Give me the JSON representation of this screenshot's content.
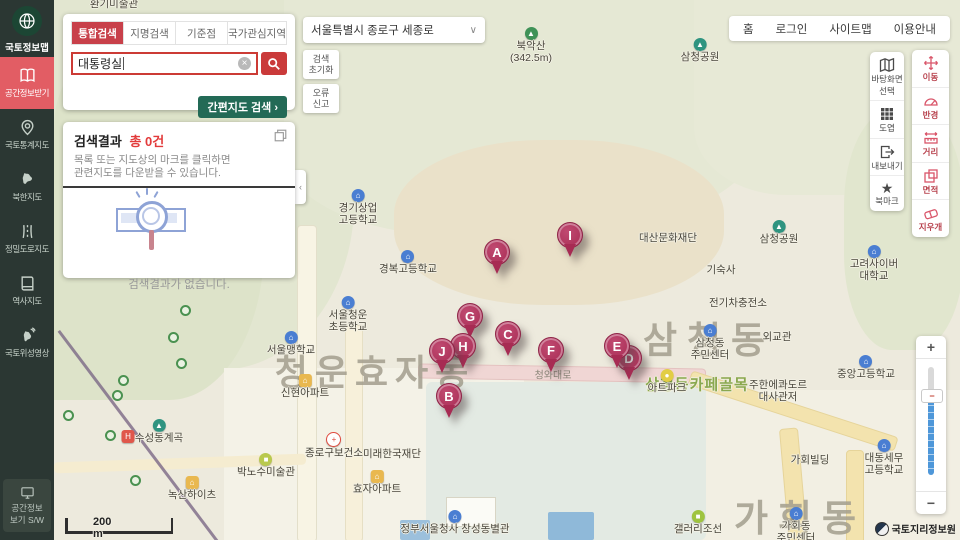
{
  "colors": {
    "sidebar_bg": "#2b3733",
    "sidebar_active": "#e25d64",
    "tab_active": "#c8404a",
    "search_border": "#cc3b35",
    "quick_button_green": "#236a56",
    "marker_pink": "#a72b53",
    "zoom_track_blue": "#4e97d9"
  },
  "icons": {
    "chevron_down": "∨",
    "arrow_right": "›",
    "collapse_left": "‹",
    "clear": "×",
    "star": "★"
  },
  "sidebar": {
    "logo_title": "국토정보맵",
    "items": [
      {
        "icon": "download-map-icon",
        "label": "공간정보받기",
        "active": true
      },
      {
        "icon": "stats-map-icon",
        "label": "국토통계지도",
        "active": false
      },
      {
        "icon": "nk-map-icon",
        "label": "북한지도",
        "active": false
      },
      {
        "icon": "road-map-icon",
        "label": "정밀도로지도",
        "active": false
      },
      {
        "icon": "history-map-icon",
        "label": "역사지도",
        "active": false
      },
      {
        "icon": "satellite-icon",
        "label": "국토위성영상",
        "active": false
      }
    ],
    "bottom": {
      "label_line1": "공간정보",
      "label_line2": "보기 S/W"
    }
  },
  "search_panel": {
    "tabs": [
      {
        "label": "통합검색",
        "active": true
      },
      {
        "label": "지명검색",
        "active": false
      },
      {
        "label": "기준점",
        "active": false
      },
      {
        "label": "국가관심지역",
        "active": false
      }
    ],
    "input_value": "대통령실",
    "quick_map_button": "간편지도 검색"
  },
  "results_panel": {
    "title": "검색결과",
    "count_text": "총 0건",
    "description_line1": "목록 또는 지도상의 마크를 클릭하면",
    "description_line2": "관련지도를 다운받을 수 있습니다.",
    "empty_text": "검색결과가 없습니다."
  },
  "top_bar": {
    "address": "서울특별시 종로구 세종로",
    "reset_button": [
      "검색",
      "초기화"
    ],
    "report_button": [
      "오류",
      "신고"
    ],
    "links": [
      "홈",
      "로그인",
      "사이트맵",
      "이용안내"
    ]
  },
  "map_tools_primary": [
    {
      "icon": "basemap-icon",
      "lines": [
        "바탕화면",
        "선택"
      ]
    },
    {
      "icon": "sheet-grid-icon",
      "lines": [
        "도엽"
      ]
    },
    {
      "icon": "export-icon",
      "lines": [
        "내보내기"
      ]
    },
    {
      "icon": "bookmark-icon",
      "lines": [
        "북마크"
      ]
    }
  ],
  "map_tools_measure": [
    {
      "icon": "move-icon",
      "lines": [
        "이동"
      ]
    },
    {
      "icon": "radius-icon",
      "lines": [
        "반경"
      ]
    },
    {
      "icon": "distance-icon",
      "lines": [
        "거리"
      ]
    },
    {
      "icon": "area-icon",
      "lines": [
        "면적"
      ]
    },
    {
      "icon": "eraser-icon",
      "lines": [
        "지우개"
      ]
    }
  ],
  "zoom_control": {
    "plus": "+",
    "minus": "−"
  },
  "scale_bar": "200 m",
  "attribution": "국토지리정보원",
  "map": {
    "districts": [
      {
        "text": "청운효자동",
        "x": 375,
        "y": 370,
        "size": 36,
        "spacing": 7
      },
      {
        "text": "삼청동",
        "x": 709,
        "y": 337,
        "size": 37,
        "spacing": 10
      },
      {
        "text": "가회동",
        "x": 800,
        "y": 515,
        "size": 37,
        "spacing": 10
      }
    ],
    "street_label": {
      "text": "삼청동카페골목",
      "x": 697,
      "y": 384
    },
    "road_label": {
      "text": "청와대로",
      "x": 553,
      "y": 374
    },
    "pois": [
      {
        "icon": null,
        "lines": [
          "환기미술관"
        ],
        "x": 114,
        "y": 5
      },
      {
        "icon": "mountain",
        "lines": [
          "북악산",
          "(342.5m)"
        ],
        "x": 531,
        "y": 34
      },
      {
        "icon": "park",
        "lines": [
          "삼청공원"
        ],
        "x": 700,
        "y": 45
      },
      {
        "icon": "park",
        "lines": [
          "삼청공원"
        ],
        "x": 779,
        "y": 227
      },
      {
        "icon": "school",
        "lines": [
          "경기상업",
          "고등학교"
        ],
        "x": 358,
        "y": 196
      },
      {
        "icon": "school",
        "lines": [
          "경복고등학교"
        ],
        "x": 408,
        "y": 257
      },
      {
        "icon": "school",
        "lines": [
          "서울청운",
          "초등학교"
        ],
        "x": 348,
        "y": 303
      },
      {
        "icon": "school",
        "lines": [
          "서울맹학교"
        ],
        "x": 291,
        "y": 338
      },
      {
        "icon": "apartment",
        "lines": [
          "신현아파트"
        ],
        "x": 305,
        "y": 381
      },
      {
        "icon": "park",
        "lines": [
          "수성동계곡"
        ],
        "x": 159,
        "y": 426
      },
      {
        "icon": "hospital",
        "lines": [],
        "x": 128,
        "y": 437
      },
      {
        "icon": "museum",
        "lines": [
          "박노수미술관"
        ],
        "x": 266,
        "y": 460
      },
      {
        "icon": "apartment",
        "lines": [
          "녹산하이츠"
        ],
        "x": 192,
        "y": 483
      },
      {
        "icon": "health",
        "lines": [
          "종로구보건소"
        ],
        "x": 334,
        "y": 439
      },
      {
        "icon": null,
        "lines": [
          "미래한국재단"
        ],
        "x": 392,
        "y": 455
      },
      {
        "icon": "apartment",
        "lines": [
          "효자아파트"
        ],
        "x": 377,
        "y": 477
      },
      {
        "icon": "govt",
        "lines": [
          "정부서울청사 창성동별관"
        ],
        "x": 455,
        "y": 517
      },
      {
        "icon": null,
        "lines": [
          "대산문화재단"
        ],
        "x": 668,
        "y": 239
      },
      {
        "icon": null,
        "lines": [
          "기숙사"
        ],
        "x": 721,
        "y": 271
      },
      {
        "icon": null,
        "lines": [
          "전기차충전소"
        ],
        "x": 738,
        "y": 304
      },
      {
        "icon": "school",
        "lines": [
          "고려사이버",
          "대학교"
        ],
        "x": 874,
        "y": 252
      },
      {
        "icon": "govt",
        "lines": [
          "삼청동",
          "주민센터"
        ],
        "x": 710,
        "y": 331
      },
      {
        "icon": null,
        "lines": [
          "외교관"
        ],
        "x": 777,
        "y": 338
      },
      {
        "icon": "school",
        "lines": [
          "중앙고등학교"
        ],
        "x": 866,
        "y": 362
      },
      {
        "icon": "attraction",
        "lines": [
          "아트파크"
        ],
        "x": 667,
        "y": 376
      },
      {
        "icon": null,
        "lines": [
          "주한에콰도르",
          "대사관저"
        ],
        "x": 778,
        "y": 386
      },
      {
        "icon": null,
        "lines": [
          "가회빌딩"
        ],
        "x": 810,
        "y": 461
      },
      {
        "icon": "school",
        "lines": [
          "대동세무",
          "고등학교"
        ],
        "x": 884,
        "y": 446
      },
      {
        "icon": "govt",
        "lines": [
          "가회동",
          "주민센터"
        ],
        "x": 796,
        "y": 514
      },
      {
        "icon": "gallery",
        "lines": [
          "갤러리조선"
        ],
        "x": 698,
        "y": 517
      }
    ],
    "markers": [
      {
        "letter": "D",
        "x": 629,
        "y": 358,
        "behind": true
      },
      {
        "letter": "A",
        "x": 497,
        "y": 252,
        "behind": false
      },
      {
        "letter": "I",
        "x": 570,
        "y": 235,
        "behind": false
      },
      {
        "letter": "G",
        "x": 470,
        "y": 316,
        "behind": false
      },
      {
        "letter": "C",
        "x": 508,
        "y": 334,
        "behind": false
      },
      {
        "letter": "F",
        "x": 551,
        "y": 350,
        "behind": false
      },
      {
        "letter": "H",
        "x": 463,
        "y": 346,
        "behind": false
      },
      {
        "letter": "J",
        "x": 442,
        "y": 351,
        "behind": false
      },
      {
        "letter": "E",
        "x": 617,
        "y": 346,
        "behind": false
      },
      {
        "letter": "B",
        "x": 449,
        "y": 396,
        "behind": false
      }
    ],
    "waypoints": [
      {
        "x": 176,
        "y": 358
      },
      {
        "x": 118,
        "y": 375
      },
      {
        "x": 112,
        "y": 390
      },
      {
        "x": 63,
        "y": 410
      },
      {
        "x": 105,
        "y": 430
      },
      {
        "x": 130,
        "y": 475
      },
      {
        "x": 180,
        "y": 305
      },
      {
        "x": 168,
        "y": 332
      }
    ]
  }
}
